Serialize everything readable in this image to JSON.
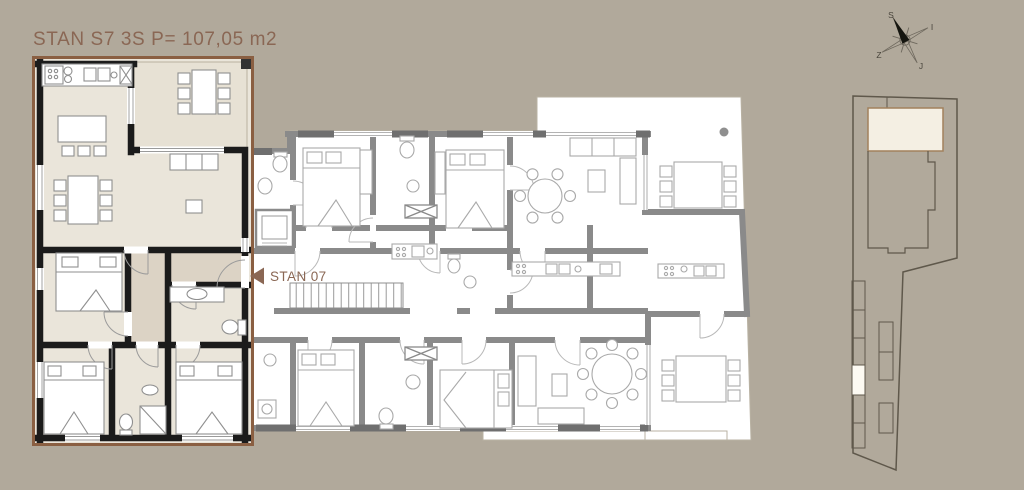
{
  "page": {
    "background_color": "#b1a99b"
  },
  "header": {
    "title": "STAN S7 3S P= 107,05 m2",
    "text_color": "#8a6754"
  },
  "callout": {
    "label": "STAN 07",
    "text_color": "#8a6754",
    "icon": "left-triangle-arrow"
  },
  "compass": {
    "north": "S",
    "east": "I",
    "west": "Z",
    "south": "J"
  },
  "colors": {
    "apartment_outline": "#8a5f42",
    "apartment_wall": "#1b1b1b",
    "apartment_floor": "#eae5da",
    "apartment_hall_floor": "#dcd3c5",
    "apartment_terrace_floor": "#e7e1d4",
    "building_wall": "#8a8a8a",
    "building_floor": "#ffffff",
    "site_boundary": "#5f584b",
    "location_highlight": "#f4efe3",
    "parking_highlight": "#fdfaf2"
  }
}
